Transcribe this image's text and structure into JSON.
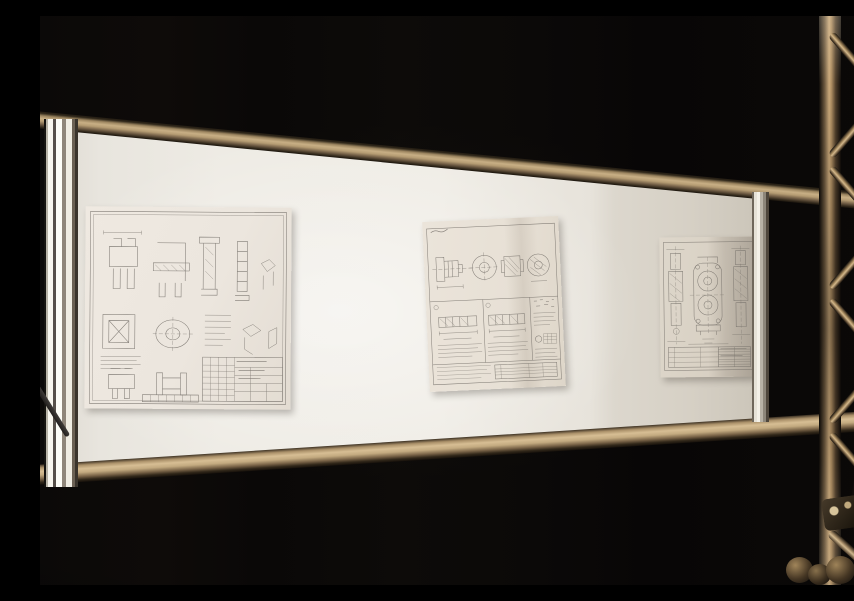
{
  "scene": {
    "description": "Photograph of a dark exhibition hall: an illuminated display board holding three engineering blueprints is mounted between bronze-toned aluminium rails next to a metal truss tower on the right",
    "environment": "dark exhibition hall, near-black backdrop",
    "colors": {
      "backdrop": "#0b0908",
      "board_surface": "#ebe8e1",
      "rail_bronze": "#c0a67d",
      "aluminium_highlight": "#f4f1e8",
      "truss_metal": "#caa97b",
      "paper": "#e9e3d9",
      "ink_lines": "#6e6963"
    }
  },
  "board": {
    "type": "illuminated whiteboard panel in aluminium frame",
    "frame_parts": [
      "top horizontal rail",
      "bottom horizontal rail",
      "left vertical post",
      "right edge cap"
    ]
  },
  "drawings": [
    {
      "id": "drawing-1",
      "orientation": "landscape",
      "description": "Engineering drawing sheet with many orthographic views of bracket and clamp parts, dimension lines, note text block and a title block at lower right"
    },
    {
      "id": "drawing-2",
      "orientation": "portrait",
      "description": "Engineering drawing of a flanged hub: four projection views on top, two stepped-shaft detail panels below, notes column and title block"
    },
    {
      "id": "drawing-3",
      "orientation": "portrait",
      "description": "Assembly drawing with central housing face view with two bores, vertical shaft views on both sides and a parts-list table at the bottom"
    }
  ],
  "truss": {
    "description": "Aluminium truss tower with two vertical chords, diagonal lacing tubes, a coupler clamp and knob hardware at the base",
    "parts": [
      "left chord",
      "right chord",
      "diagonal braces",
      "coupler clamp",
      "knob hardware",
      "dark equipment silhouette"
    ]
  }
}
